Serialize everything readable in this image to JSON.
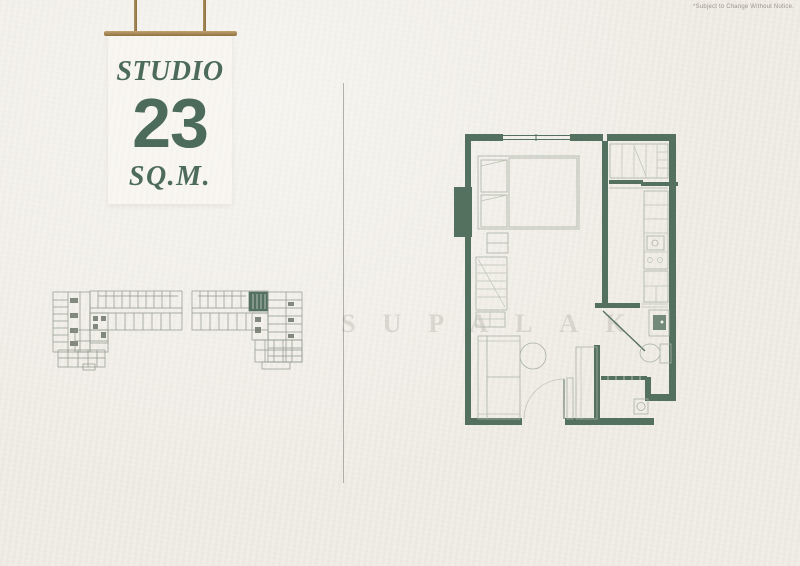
{
  "disclaimer": "*Subject to Change Without Notice.",
  "watermark": "SUPALAK",
  "sign": {
    "type_label": "STUDIO",
    "area_value": "23",
    "area_unit": "SQ.M."
  },
  "colors": {
    "accent": "#4d6b5a",
    "wall": "#54705e",
    "furn": "#a9b2a3",
    "furnlight": "#bcc3b5",
    "kpline": "#8f988b",
    "kpdark": "#6d7669",
    "paper": "#f0ede6",
    "card": "#f8f6f0",
    "rod": "#ad9161",
    "rod_dark": "#8d713f",
    "divider": "#8c8c86",
    "disclaimer_text": "#9a968c",
    "watermark_color": "rgba(125,120,105,0.20)"
  }
}
